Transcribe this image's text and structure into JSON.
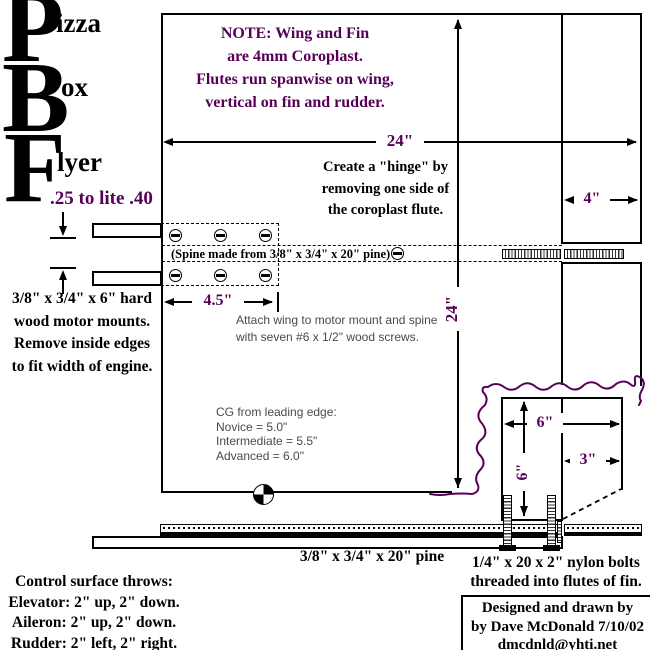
{
  "title": {
    "p": "P",
    "izza": "izza",
    "b": "B",
    "ox": "ox",
    "f": "F",
    "lyer": "lyer",
    "engine_range": ".25 to lite .40"
  },
  "note": {
    "l1": "NOTE:  Wing and Fin",
    "l2": "are 4mm Coroplast.",
    "l3": "Flutes run spanwise on wing,",
    "l4": "vertical on fin and rudder."
  },
  "dims": {
    "span": "24\"",
    "chord": "24\"",
    "elevator": "4\"",
    "mount_offset": "4.5\"",
    "fin_width": "6\"",
    "fin_height": "6\"",
    "rudder": "3\""
  },
  "hinge_note": {
    "l1": "Create a \"hinge\" by",
    "l2": "removing one side of",
    "l3": "the coroplast flute."
  },
  "spine_label": "(Spine made from 3/8\" x 3/4\" x 20\" pine)",
  "mount_note": {
    "l1": "3/8\" x 3/4\" x 6\" hard",
    "l2": "wood motor mounts.",
    "l3": "Remove inside edges",
    "l4": "to fit width of engine."
  },
  "attach_note": {
    "l1": "Attach wing to motor mount and spine",
    "l2": "with seven #6 x 1/2\" wood screws."
  },
  "cg_note": {
    "l1": "CG from leading edge:",
    "l2": "Novice = 5.0\"",
    "l3": "Intermediate = 5.5\"",
    "l4": "Advanced = 6.0\""
  },
  "pine_label": "3/8\" x 3/4\" x 20\" pine",
  "bolt_note": {
    "l1": "1/4\" x 20 x 2\" nylon bolts",
    "l2": "threaded into flutes of fin."
  },
  "control_throws": {
    "l1": "Control surface throws:",
    "l2": "Elevator:  2\" up, 2\" down.",
    "l3": "Aileron:  2\" up, 2\" down.",
    "l4": "Rudder:  2\" left, 2\" right."
  },
  "credit": {
    "l1": "Designed and drawn by",
    "l2": "by Dave McDonald 7/10/02",
    "l3": "dmcdnld@yhti.net"
  },
  "colors": {
    "accent": "#570057",
    "ink": "#000000",
    "annotation": "#4a4a4a"
  }
}
